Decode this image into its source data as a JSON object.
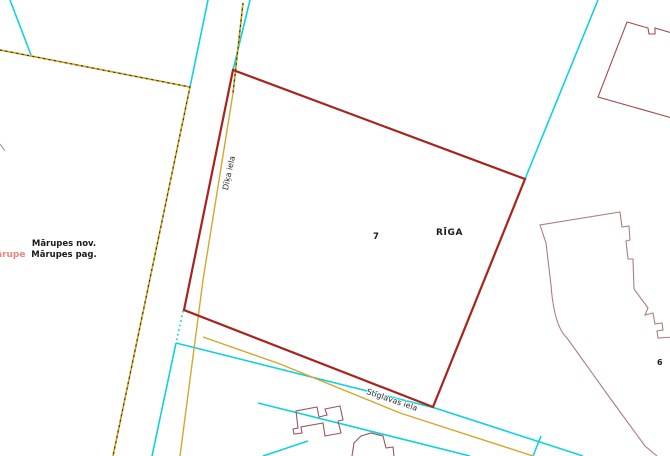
{
  "title": "Cadastral map view",
  "map": {
    "region_labels": {
      "city": "RĪGA",
      "municipality": {
        "line1": "Mārupes nov.",
        "line2": "Mārupes pag."
      },
      "place_partial": "ārupe"
    },
    "parcel_labels": {
      "subject": "7",
      "adjacent": "6"
    },
    "street_labels": {
      "vertical": "Dīķa iela",
      "horizontal": "Stīglavas iela"
    },
    "colors": {
      "parcel_outline": "#a8231d",
      "cadastre_line": "#0fd2dc",
      "road_centerline": "#d4a72c",
      "boundary_dashed": "#c8a41e",
      "boundary_dash_dark": "#222222",
      "building_outline": "#9d4f4f",
      "building_outline_light": "#ab7e7e",
      "building_outline_small": "#97565e",
      "place_text": "#e78585",
      "label_text": "#1a1a1a",
      "edge_tick": "#9aa7b5"
    }
  }
}
